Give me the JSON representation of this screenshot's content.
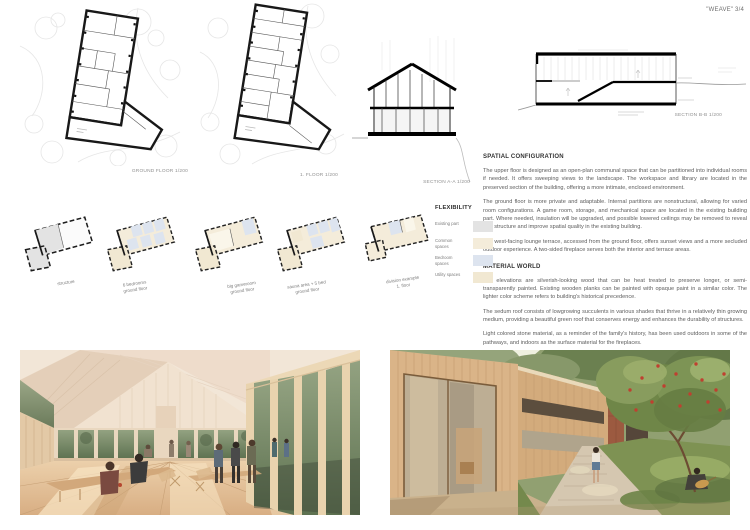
{
  "page": {
    "title": "\"WEAVE\" 3/4"
  },
  "drawings": {
    "ground_floor_label": "GROUND FLOOR 1/200",
    "first_floor_label": "1. FLOOR 1/200",
    "section_aa_label": "SECTION A-A 1/200",
    "section_bb_label": "SECTION B-B 1/200"
  },
  "flexibility": {
    "title": "FLEXIBILITY",
    "legend": [
      {
        "label": "Existing part",
        "color": "#e3e3e3"
      },
      {
        "label": "Common spaces",
        "color": "#f4ecda"
      },
      {
        "label": "Bedroom spaces",
        "color": "#dde4ef"
      },
      {
        "label": "Utility spaces",
        "color": "#f1e8d2"
      }
    ],
    "diagrams": [
      {
        "caption": "structure"
      },
      {
        "caption": "6 bedrooms\nground floor"
      },
      {
        "caption": "big gameroom\nground floor"
      },
      {
        "caption": "sauna area + 5 bed\nground floor"
      },
      {
        "caption": "division example\n1. floor"
      }
    ]
  },
  "sections": {
    "spatial": {
      "heading": "SPATIAL CONFIGURATION",
      "paragraphs": [
        "The upper floor is designed as an open-plan communal space that can be partitioned into individual rooms if needed. It offers sweeping views to the landscape. The workspace and library are located in the preserved section of the building, offering a more intimate, enclosed environment.",
        "The ground floor is more private and adaptable. Internal partitions are nonstructural, allowing for varied room configurations. A game room, storage, and mechanical space are located in the existing building part. Where needed, insulation will be upgraded, and possible lowered ceilings may be removed to reveal roof structure and improve spatial quality in the existing building.",
        "The west-facing lounge terrace, accessed from the ground floor, offers sunset views and a more secluded outdoor experience. A two-sided fireplace serves both the interior and terrace areas."
      ]
    },
    "material": {
      "heading": "MATERIAL WORLD",
      "paragraphs": [
        "The elevations are silverish-looking wood that can be heat treated to preserve longer, or semi-transparently painted. Existing wooden planks can be painted with opaque paint in a similar color. The lighter color scheme refers to building's historical precedence.",
        "The sedum roof consists of lowgrowing succulents in various shades that thrive in a relatively thin growing medium, providing a beautiful green roof that conserves energy and enhances the durability of structures.",
        "Light colored stone material, as a reminder of the family's history, has been used outdoors in some of the pathways, and indoors as the surface material for the fireplaces."
      ]
    }
  }
}
